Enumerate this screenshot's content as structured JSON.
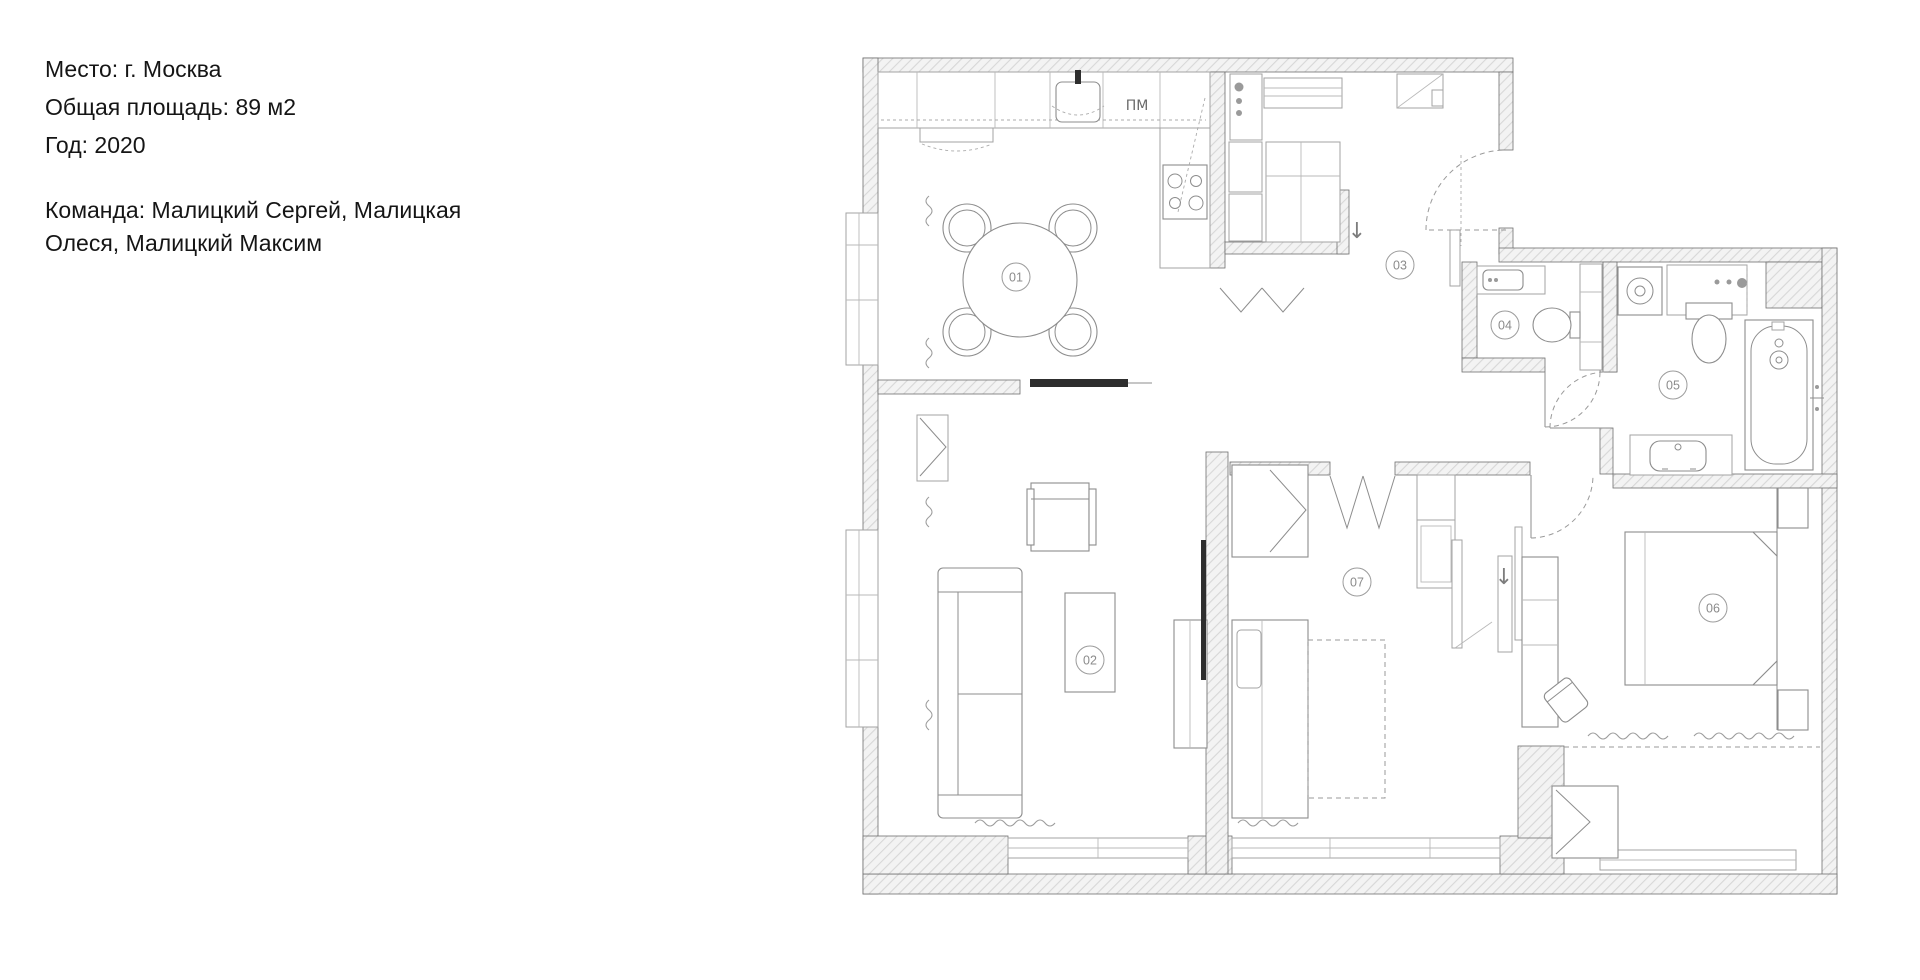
{
  "project_info": {
    "location": "Место: г. Москва",
    "area": "Общая площадь: 89 м2",
    "year": "Год: 2020",
    "team": "Команда: Малицкий Сергей, Малицкая Олеся, Малицкий Максим"
  },
  "plan": {
    "room_labels": [
      "01",
      "02",
      "03",
      "04",
      "05",
      "06",
      "07"
    ],
    "annotations": {
      "dishwasher_label": "ПМ",
      "entry_arrow": "↓",
      "closet_arrow": "↓"
    }
  }
}
